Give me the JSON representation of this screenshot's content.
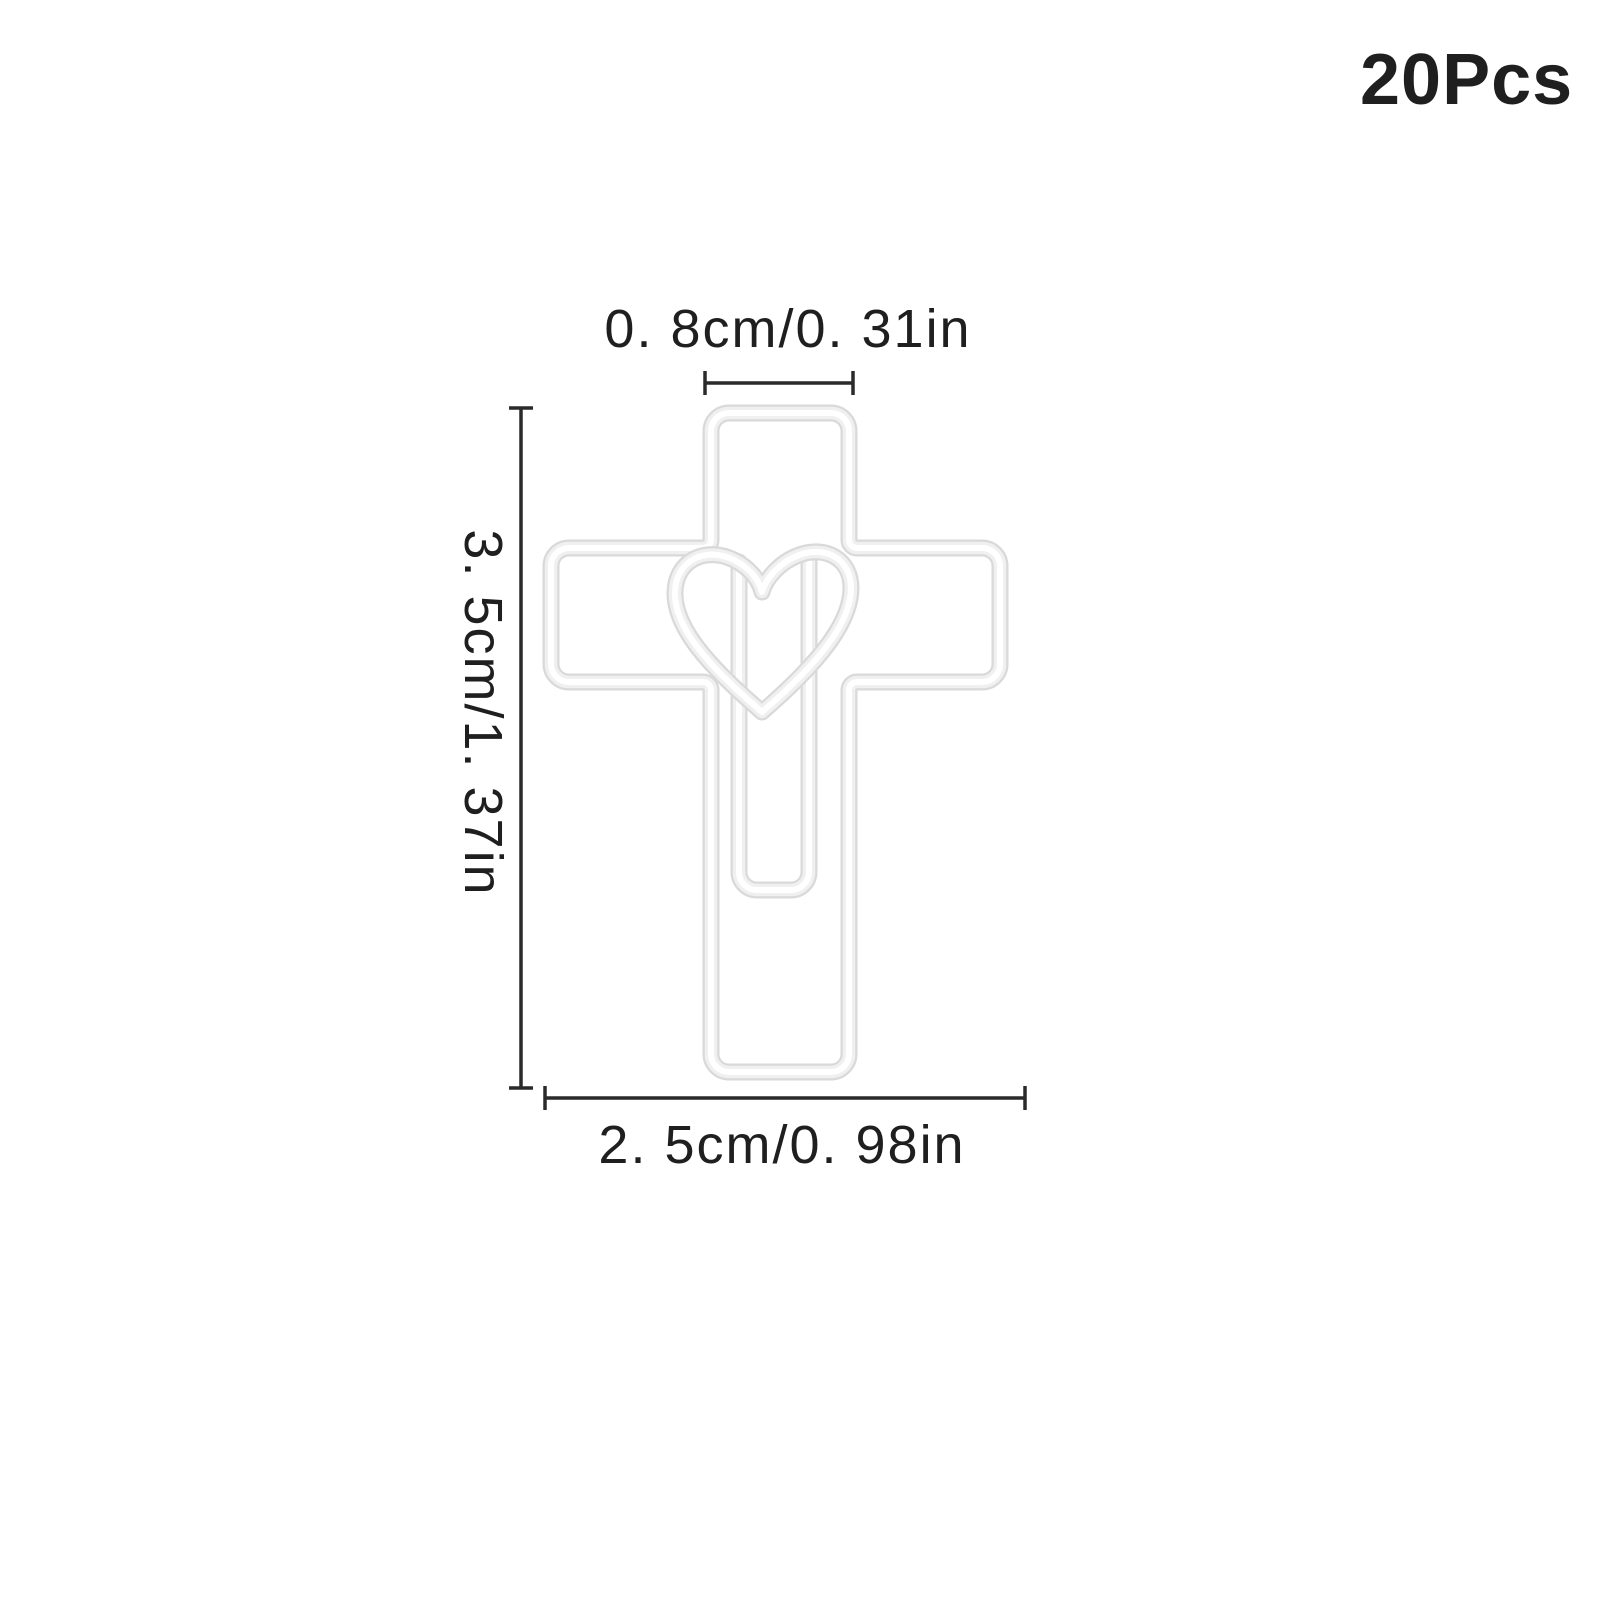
{
  "product": {
    "quantity_label": "20Pcs",
    "graphic": "cross-heart-paperclip"
  },
  "dimensions": {
    "top_width": "0. 8cm/0. 31in",
    "height": "3. 5cm/1. 37in",
    "bottom_width": "2. 5cm/0. 98in"
  },
  "colors": {
    "text": "#1f1f1f",
    "dimension_line": "#2a2a2a",
    "wire_edge": "#d9d9d9",
    "wire_mid": "#f0f0f0",
    "wire_highlight": "#ffffff",
    "background": "#ffffff"
  }
}
